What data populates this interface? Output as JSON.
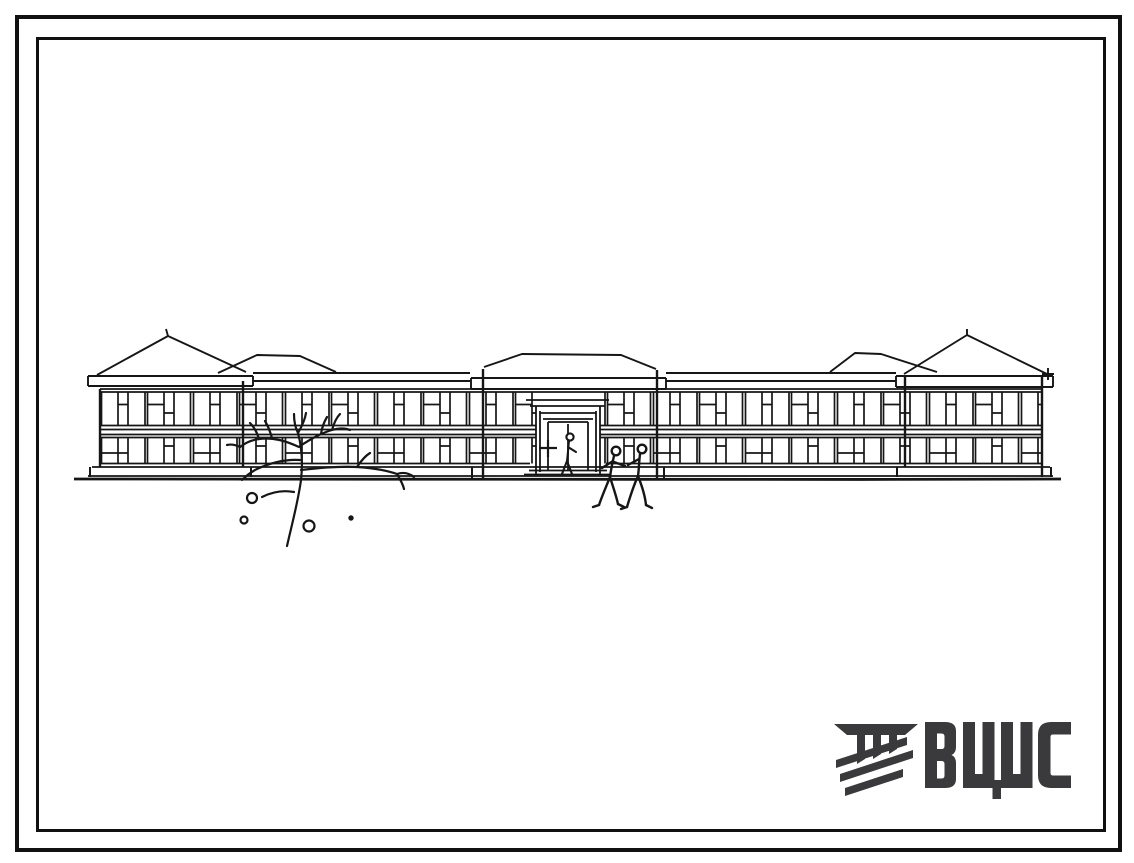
{
  "document": {
    "background_color": "#ffffff",
    "frame_color": "#111111",
    "ink_color": "#161616"
  },
  "drawing": {
    "subject": "Front elevation sketch: long two-storey building with three hipped-roof pavilions, ribbon windows, central entrance, bare tree and two pedestrians"
  },
  "logo": {
    "text": "ВЦИС",
    "color": "#3a3a3c",
    "icon": "hatched-beam-emblem"
  }
}
